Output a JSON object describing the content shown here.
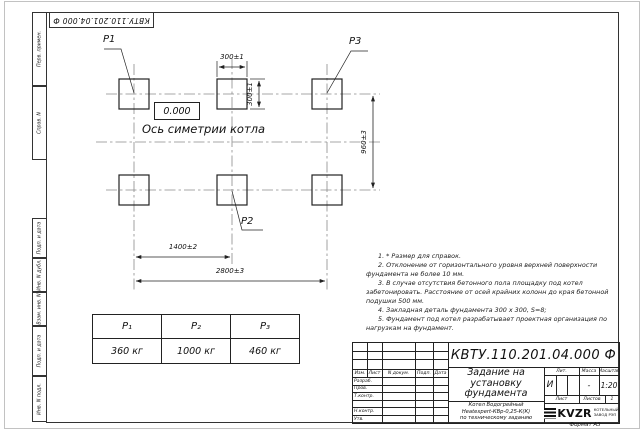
{
  "frame": {
    "top_designation": "КВТУ.110.201.04.000 Ф",
    "format_label": "Формат А3",
    "margin_cells": [
      "Перв. примен.",
      "Справ. N",
      "Подп. и дата",
      "Инв. N дубл.",
      "Взам. инв. N",
      "Подп. и дата",
      "Инв. N подл."
    ]
  },
  "drawing": {
    "p1": "P1",
    "p2": "P2",
    "p3": "P3",
    "elevation": "0.000",
    "axis_label": "Ось симетрии котла",
    "dims": {
      "pad_width": "300±1",
      "pad_height": "300±1",
      "row_spacing": "960±3",
      "col_spacing": "1400±2",
      "total_width": "2800±3"
    }
  },
  "notes": {
    "items": [
      "1. * Размер для справок.",
      "2. Отклонение от горизонтального уровня верхней поверхности фундамента не более 10 мм.",
      "3. В случае отсутствия бетонного пола площадку под котел забетонировать. Расстояние от осей крайних колонн до края бетонной подушки 500 мм.",
      "4. Закладная деталь фундамента  300 х 300, S=8;",
      "5. Фундамент под котел разрабатывает проектная организация по нагрузкам на фундамент."
    ]
  },
  "load_table": {
    "headers": [
      "P₁",
      "P₂",
      "P₃"
    ],
    "values": [
      "360 кг",
      "1000 кг",
      "460 кг"
    ]
  },
  "title_block": {
    "designation": "КВТУ.110.201.04.000 Ф",
    "doc_name": "Задание на установку фундамента",
    "product_lines": [
      "Котел Водогрейный",
      "Heatexpert-КВр-0,25-К(К)",
      "по техническому заданию"
    ],
    "header_cols": [
      "Изм.",
      "Лист",
      "N докум.",
      "Подп.",
      "Дата"
    ],
    "row_labels": [
      "Разраб.",
      "Пров.",
      "Т.контр.",
      "Н.контр.",
      "Утв."
    ],
    "lit": {
      "label": "Лит.",
      "value": "И"
    },
    "mass": {
      "label": "Масса",
      "value": "-"
    },
    "scale": {
      "label": "Масштаб",
      "value": "1:20"
    },
    "sheet_label": "Лист",
    "sheets_label": "Листов",
    "sheets_value": "1",
    "logo_text": "KVZR",
    "company_line1": "КОТЕЛЬНЫЙ",
    "company_line2": "ЗАВОД РЭП"
  }
}
